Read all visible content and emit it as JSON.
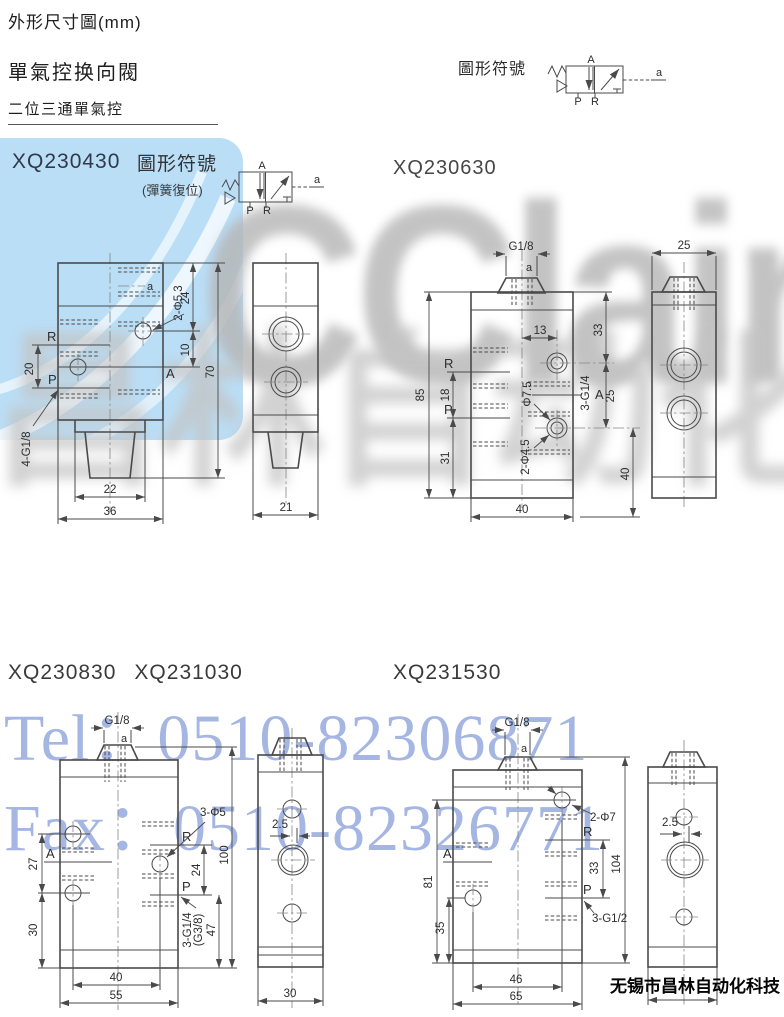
{
  "header": {
    "title": "外形尺寸圖(mm)",
    "product": "單氣控换向閥",
    "section": "二位三通單氣控",
    "symbol_label": "圖形符號"
  },
  "models": {
    "m1": "XQ230430",
    "m2": "XQ230630",
    "m3": "XQ230830",
    "m3b": "XQ231030",
    "m4": "XQ231530"
  },
  "symbols": {
    "label2": "圖形符號",
    "sub2": "(彈簧復位)",
    "A": "A",
    "P": "P",
    "R": "R",
    "a": "a"
  },
  "d1": {
    "a": "a",
    "R": "R",
    "P": "P",
    "A": "A",
    "d20": "20",
    "d24": "24",
    "d10": "10",
    "d70": "70",
    "hole": "2-Φ5.3",
    "thread": "4-G1/8",
    "d22": "22",
    "d36": "36"
  },
  "d2": {
    "d21": "21"
  },
  "d3": {
    "g": "G1/8",
    "a": "a",
    "d85": "85",
    "R": "R",
    "d18": "18",
    "P": "P",
    "d31": "31",
    "d13": "13",
    "d33": "33",
    "d25": "25",
    "A": "A",
    "thread": "3-G1/4",
    "h75": "Φ7.5",
    "h45": "2-Φ4.5",
    "d40v": "40",
    "d40": "40"
  },
  "d4": {
    "d25": "25"
  },
  "d5": {
    "g": "G1/8",
    "a": "a",
    "A": "A",
    "R": "R",
    "P": "P",
    "d27": "27",
    "d30": "30",
    "d24": "24",
    "d100": "100",
    "d47": "47",
    "hole": "3-Φ5",
    "thread1": "3-G1/4",
    "thread2": "(G3/8)",
    "d40": "40",
    "d55": "55"
  },
  "d6": {
    "d25": "2.5",
    "d30": "30"
  },
  "d7": {
    "g": "G1/8",
    "a": "a",
    "A": "A",
    "R": "R",
    "P": "P",
    "d81": "81",
    "d35": "35",
    "d33": "33",
    "d104": "104",
    "hole": "2-Φ7",
    "thread": "3-G1/2",
    "d46": "46",
    "d65": "65"
  },
  "d8": {
    "d25": "2.5"
  },
  "watermarks": {
    "brand": "CClair",
    "cn": "昌林自动化",
    "tel": "Tel：0510-82306871",
    "fax": "Fax：0510-82326771",
    "company": "无锡市昌林自动化科技"
  }
}
